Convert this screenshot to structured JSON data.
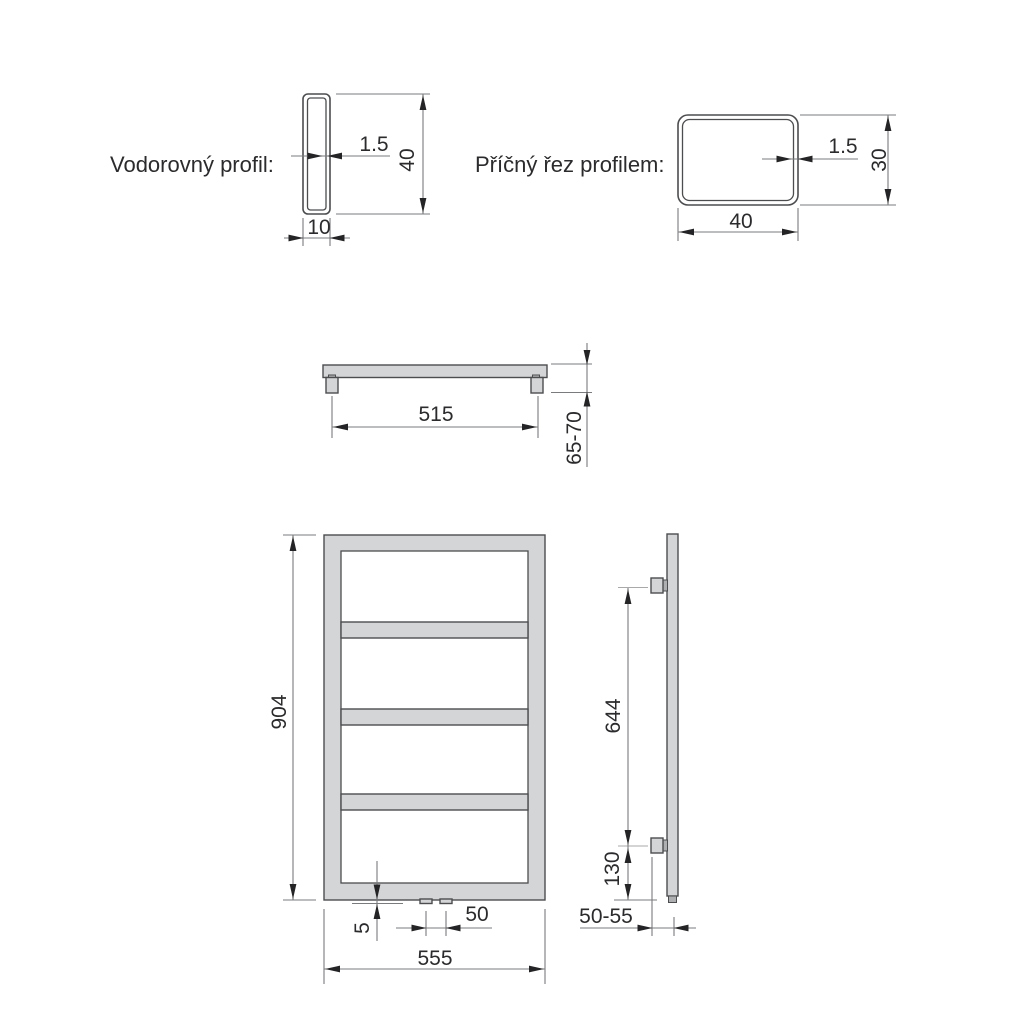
{
  "drawing_type": "radiator-technical-drawing",
  "colors": {
    "background": "#ffffff",
    "metal_fill": "#d4d5d7",
    "metal_fill_dark": "#aeafb1",
    "outline": "#4c4d4f",
    "dimension_line": "#7a7b7d",
    "text": "#2b2b2d"
  },
  "sections": {
    "horizontal_profile": {
      "label": "Vodorovný profil:",
      "wall_thickness": "1.5",
      "height": "40",
      "width": "10"
    },
    "cross_section": {
      "label": "Příčný řez profilem:",
      "wall_thickness": "1.5",
      "height": "30",
      "width": "40"
    },
    "top_view": {
      "bracket_spacing": "515",
      "wall_depth": "65-70"
    },
    "front_view": {
      "height": "904",
      "connection_protrusion": "5",
      "connection_spacing": "50",
      "width": "555"
    },
    "side_view": {
      "bracket_span": "644",
      "bottom_bracket_offset": "130",
      "wall_distance": "50-55"
    }
  }
}
